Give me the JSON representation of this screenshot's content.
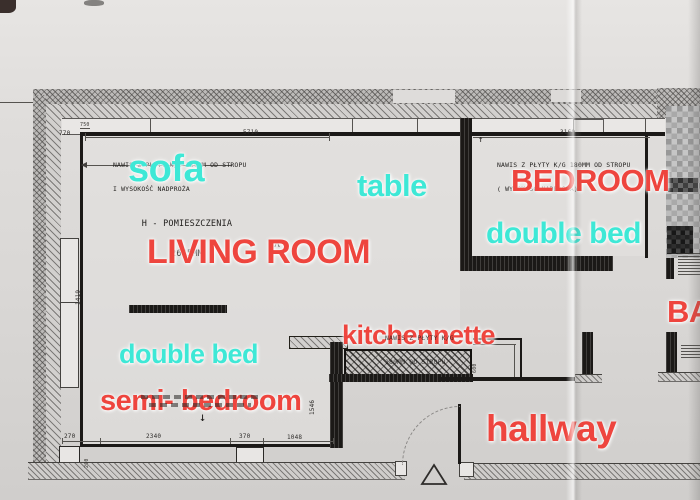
{
  "labels": {
    "sofa": "sofa",
    "table": "table",
    "bedroom": "BEDROOM",
    "bedroom_double_bed": "double bed",
    "living_room": "LIVING ROOM",
    "kitchennette": "kitchennette",
    "living_double_bed": "double bed",
    "semi_bedroom": "semi- bedroom",
    "hallway": "hallway",
    "bathroom_partial": "BA"
  },
  "notes": {
    "living_overhang_l1": "NAWIS Z PŁYTY K/G 180MM OD STROPU",
    "living_overhang_l2": "I WYSOKOŚĆ NADPROŻA",
    "room_height_l1": "H - POMIESZCZENIA",
    "room_height_l2": "2645MM",
    "bedroom_overhang_l1": "NAWIS Z PŁYTY K/G 180MM OD STROPU",
    "bedroom_overhang_l2": "( WYSOKOŚĆ NADPROŻA)",
    "kitchen_overhang_l1": "NAWIS Z PŁYTY K/G",
    "kitchen_overhang_l2": "180MM OD STROPU"
  },
  "dimensions": {
    "living_top_width": "5710",
    "bedroom_top_width": "3160",
    "left_top": "770",
    "left_top_small": "750",
    "bottom_seg1": "270",
    "bottom_seg2": "2340",
    "bottom_seg3": "370",
    "bottom_seg4": "1048",
    "right_vertical": "1546",
    "left_vertical": "1419",
    "window_depth": "200",
    "recess_width": "600"
  },
  "symbols": {
    "up_arrow": "↑",
    "down_arrow": "↓",
    "caret": "ʌ"
  },
  "colors": {
    "label_red": "#ee453e",
    "label_cyan": "#3ee8d6",
    "plan_line": "#1b1917",
    "paper": "#dbd9d7"
  }
}
